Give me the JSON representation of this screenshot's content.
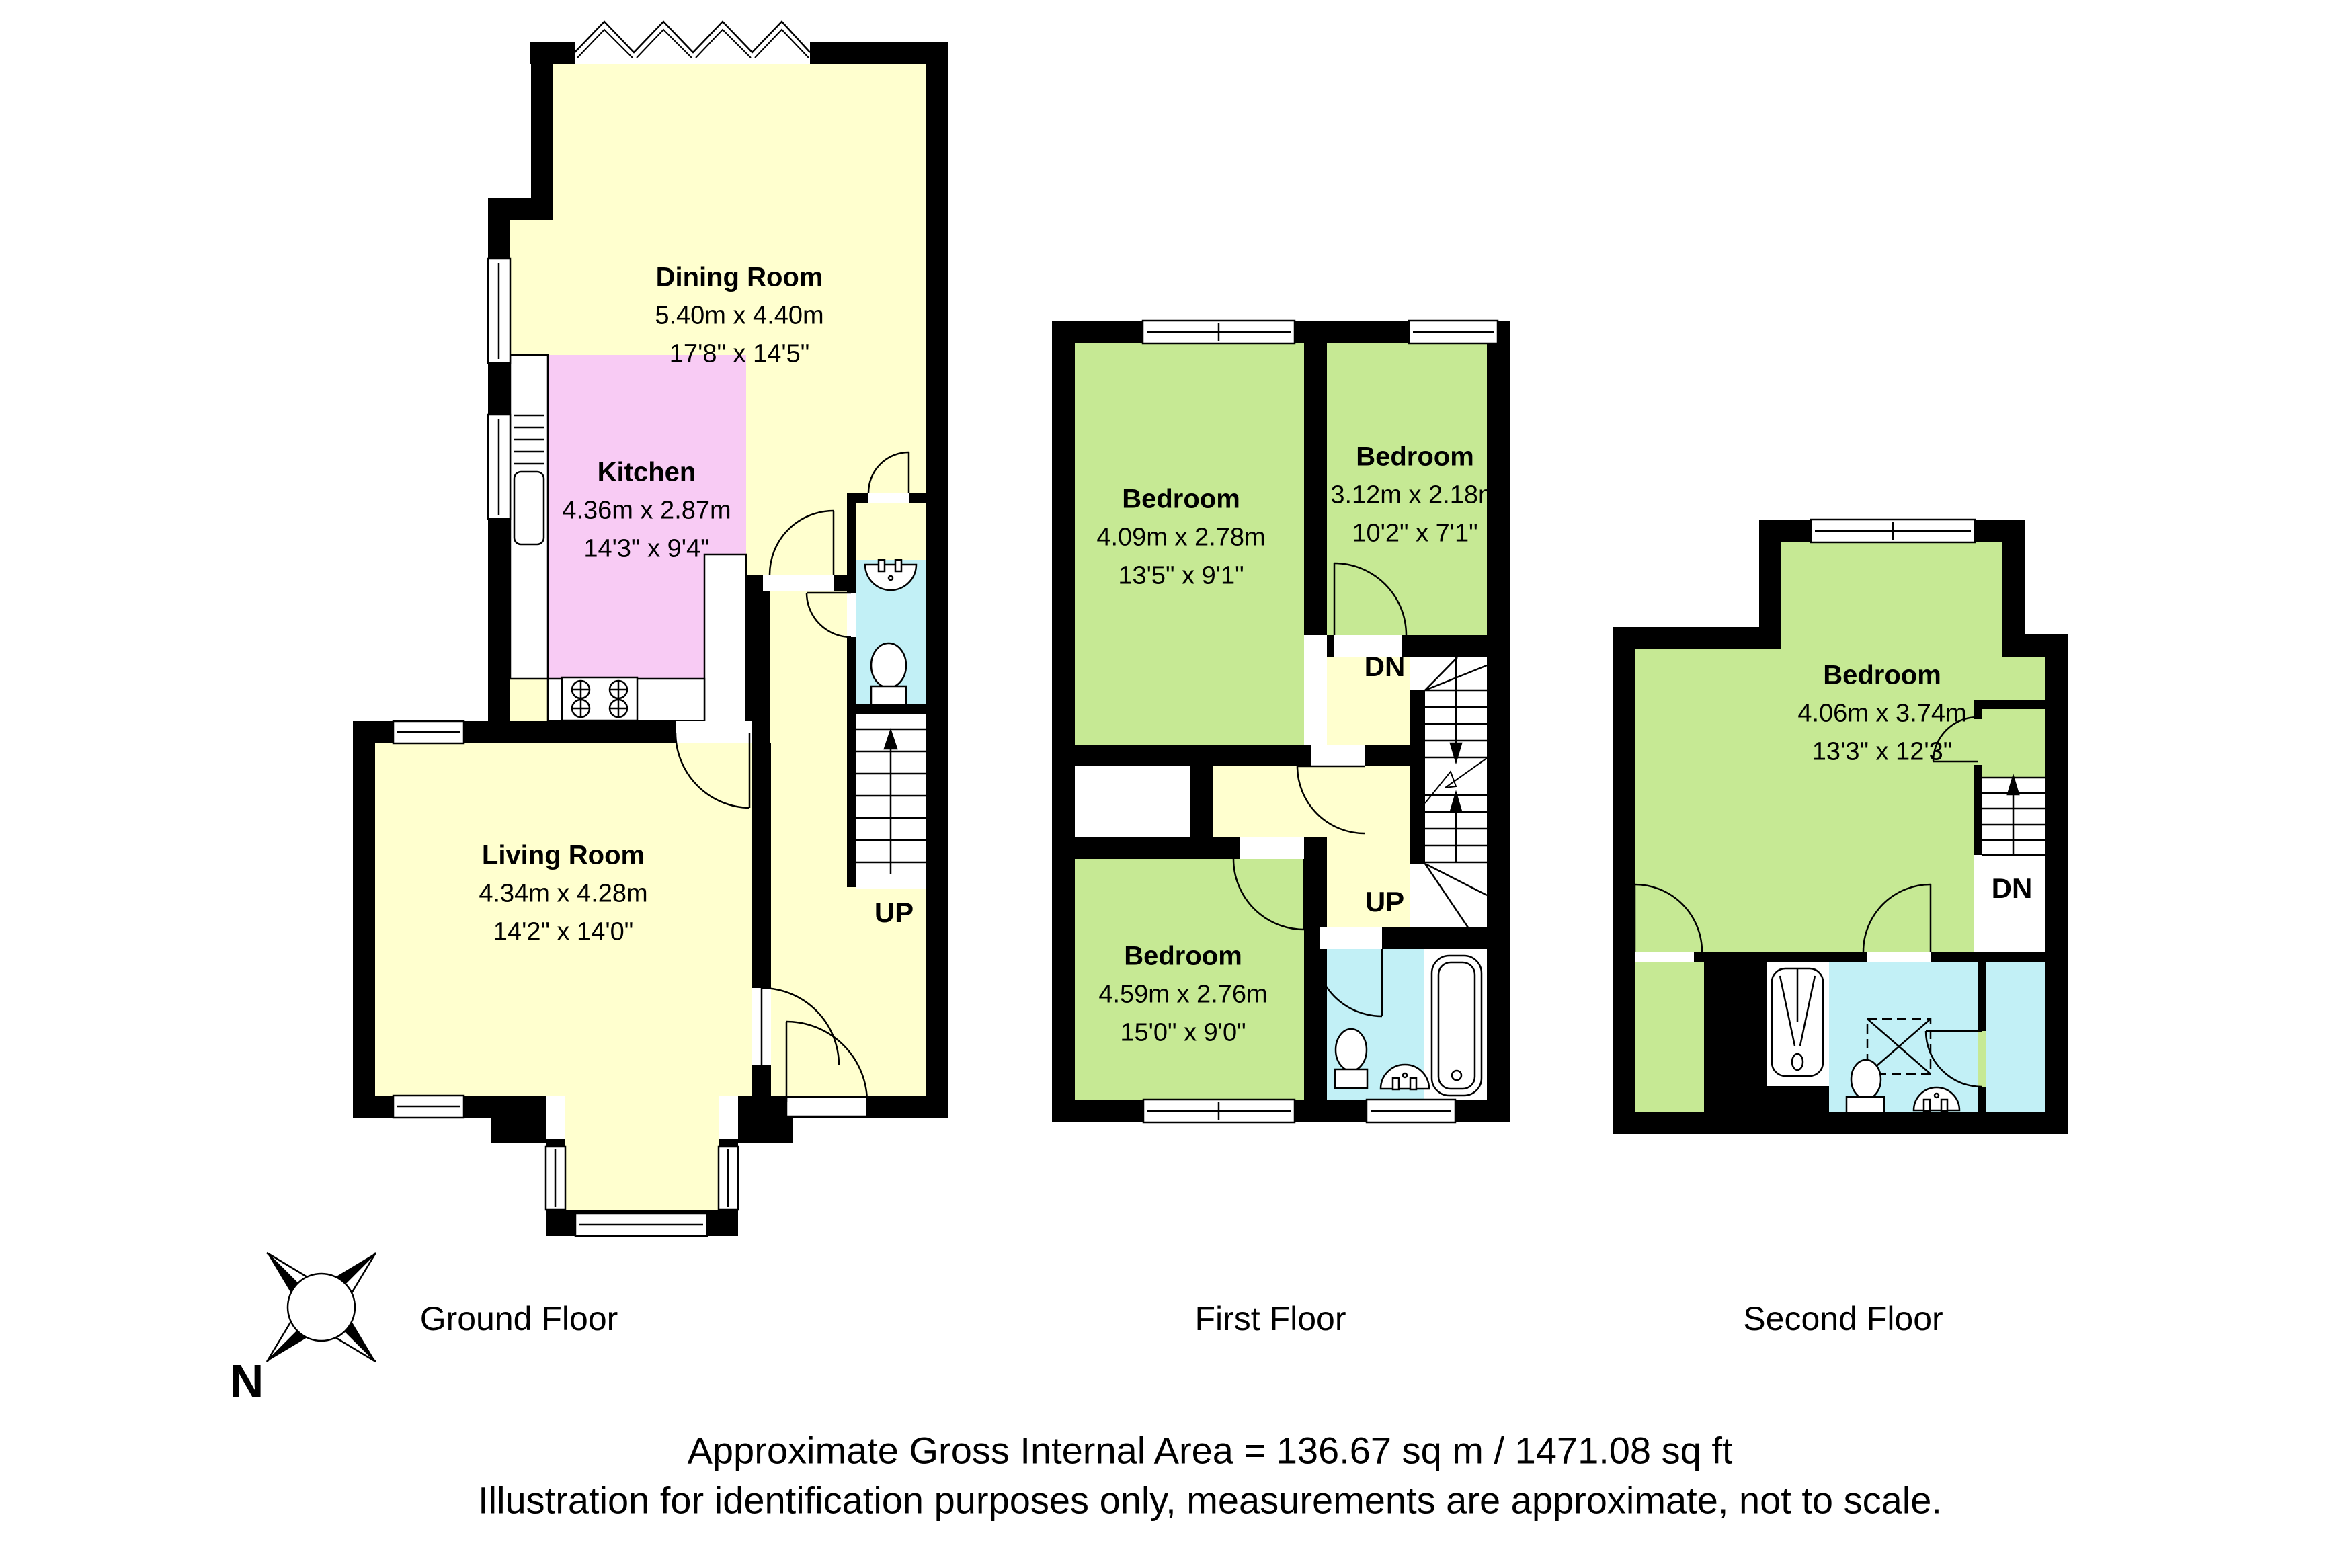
{
  "colors": {
    "wall": "#000000",
    "room_yellow": "#FFFFCF",
    "kitchen_pink": "#F8CBF4",
    "bedroom_green": "#C6E994",
    "bathroom_cyan": "#C2F0F6"
  },
  "floors": {
    "ground": {
      "label": "Ground Floor",
      "stair_up": "UP",
      "rooms": {
        "dining": {
          "name": "Dining Room",
          "metric": "5.40m x 4.40m",
          "imperial": "17'8\" x 14'5\""
        },
        "kitchen": {
          "name": "Kitchen",
          "metric": "4.36m x 2.87m",
          "imperial": "14'3\" x 9'4\""
        },
        "living": {
          "name": "Living Room",
          "metric": "4.34m x 4.28m",
          "imperial": "14'2\" x 14'0\""
        }
      }
    },
    "first": {
      "label": "First Floor",
      "stair_dn": "DN",
      "stair_up": "UP",
      "rooms": {
        "bedroom1": {
          "name": "Bedroom",
          "metric": "4.09m x 2.78m",
          "imperial": "13'5\" x 9'1\""
        },
        "bedroom2": {
          "name": "Bedroom",
          "metric": "3.12m x 2.18m",
          "imperial": "10'2\" x 7'1\""
        },
        "bedroom3": {
          "name": "Bedroom",
          "metric": "4.59m x 2.76m",
          "imperial": "15'0\" x 9'0\""
        }
      }
    },
    "second": {
      "label": "Second Floor",
      "stair_dn": "DN",
      "rooms": {
        "bedroom": {
          "name": "Bedroom",
          "metric": "4.06m x 3.74m",
          "imperial": "13'3\" x 12'3\""
        }
      }
    }
  },
  "compass": {
    "north_label": "N"
  },
  "footer": {
    "area_line": "Approximate Gross Internal Area = 136.67 sq m / 1471.08 sq ft",
    "disclaimer_line": "Illustration for identification purposes only, measurements are approximate, not to scale."
  }
}
